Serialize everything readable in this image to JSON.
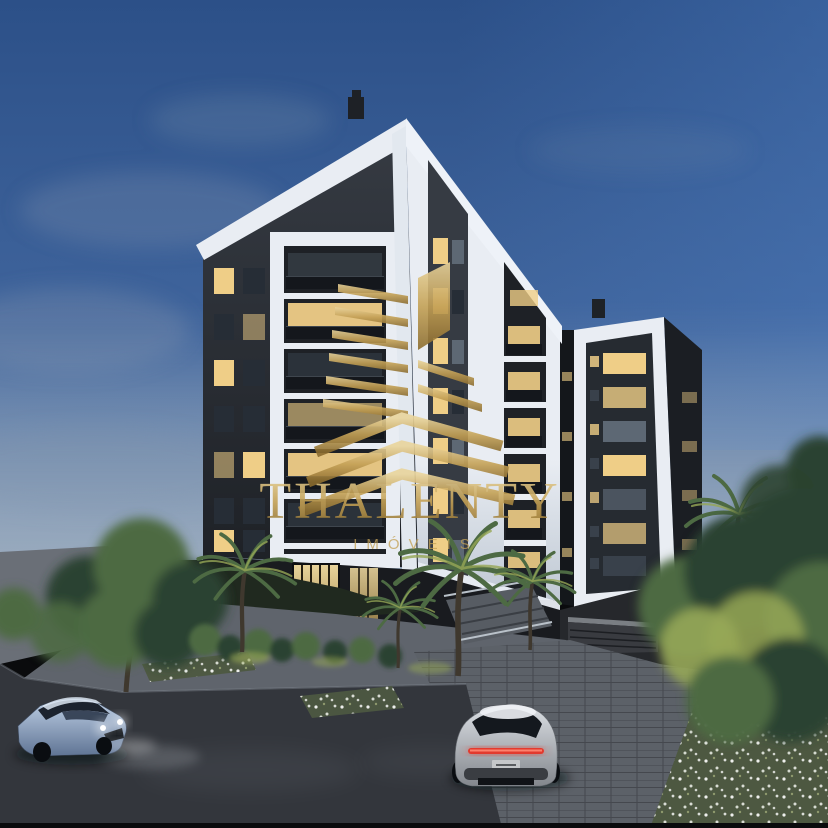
{
  "watermark": {
    "brand": "THALENTY",
    "tagline": "IMÓVEIS"
  },
  "scene": {
    "description": "Dusk 3D architectural rendering of a modern dark-and-white residential tower with landscaped entrance, palm trees, a street with a blue sedan and a silver sports car, overlaid with a gold real-estate watermark"
  },
  "palette": {
    "sky_top": "#2c5088",
    "sky_mid": "#40659d",
    "sky_right": "#4f80c4",
    "sky_haze": "#9fafc0",
    "cloud": "#8799b0",
    "facade_white": "#e9edf3",
    "facade_shade": "#bfc8d3",
    "facade_dark": "#363b43",
    "facade_darker": "#1e2126",
    "window_lit": "#efce87",
    "window_blue": "#5d6874",
    "window_dark": "#262d36",
    "rail_dark": "#14171c",
    "gold_light": "#e9d49c",
    "gold": "#c4a156",
    "gold_dark": "#8b6c2f",
    "podium_dark": "#191b1f",
    "garage_door": "#393b40",
    "sidewalk": "#6a6f77",
    "walkway": "#5f646c",
    "pavers": "#5c6168",
    "asphalt": "#33363c",
    "soil": "#20291f",
    "foliage_dark": "#2b4230",
    "foliage_mid": "#4d6a43",
    "foliage_lit": "#96a756",
    "flower_base": "#4d5841",
    "trunk": "#3f382e",
    "car_blue_light": "#bfd0e6",
    "car_blue_dark": "#5f7494",
    "car_silver_light": "#dde1e6",
    "car_silver_dark": "#83878d",
    "taillight": "#e23a2e",
    "headlight": "#ffffff"
  }
}
